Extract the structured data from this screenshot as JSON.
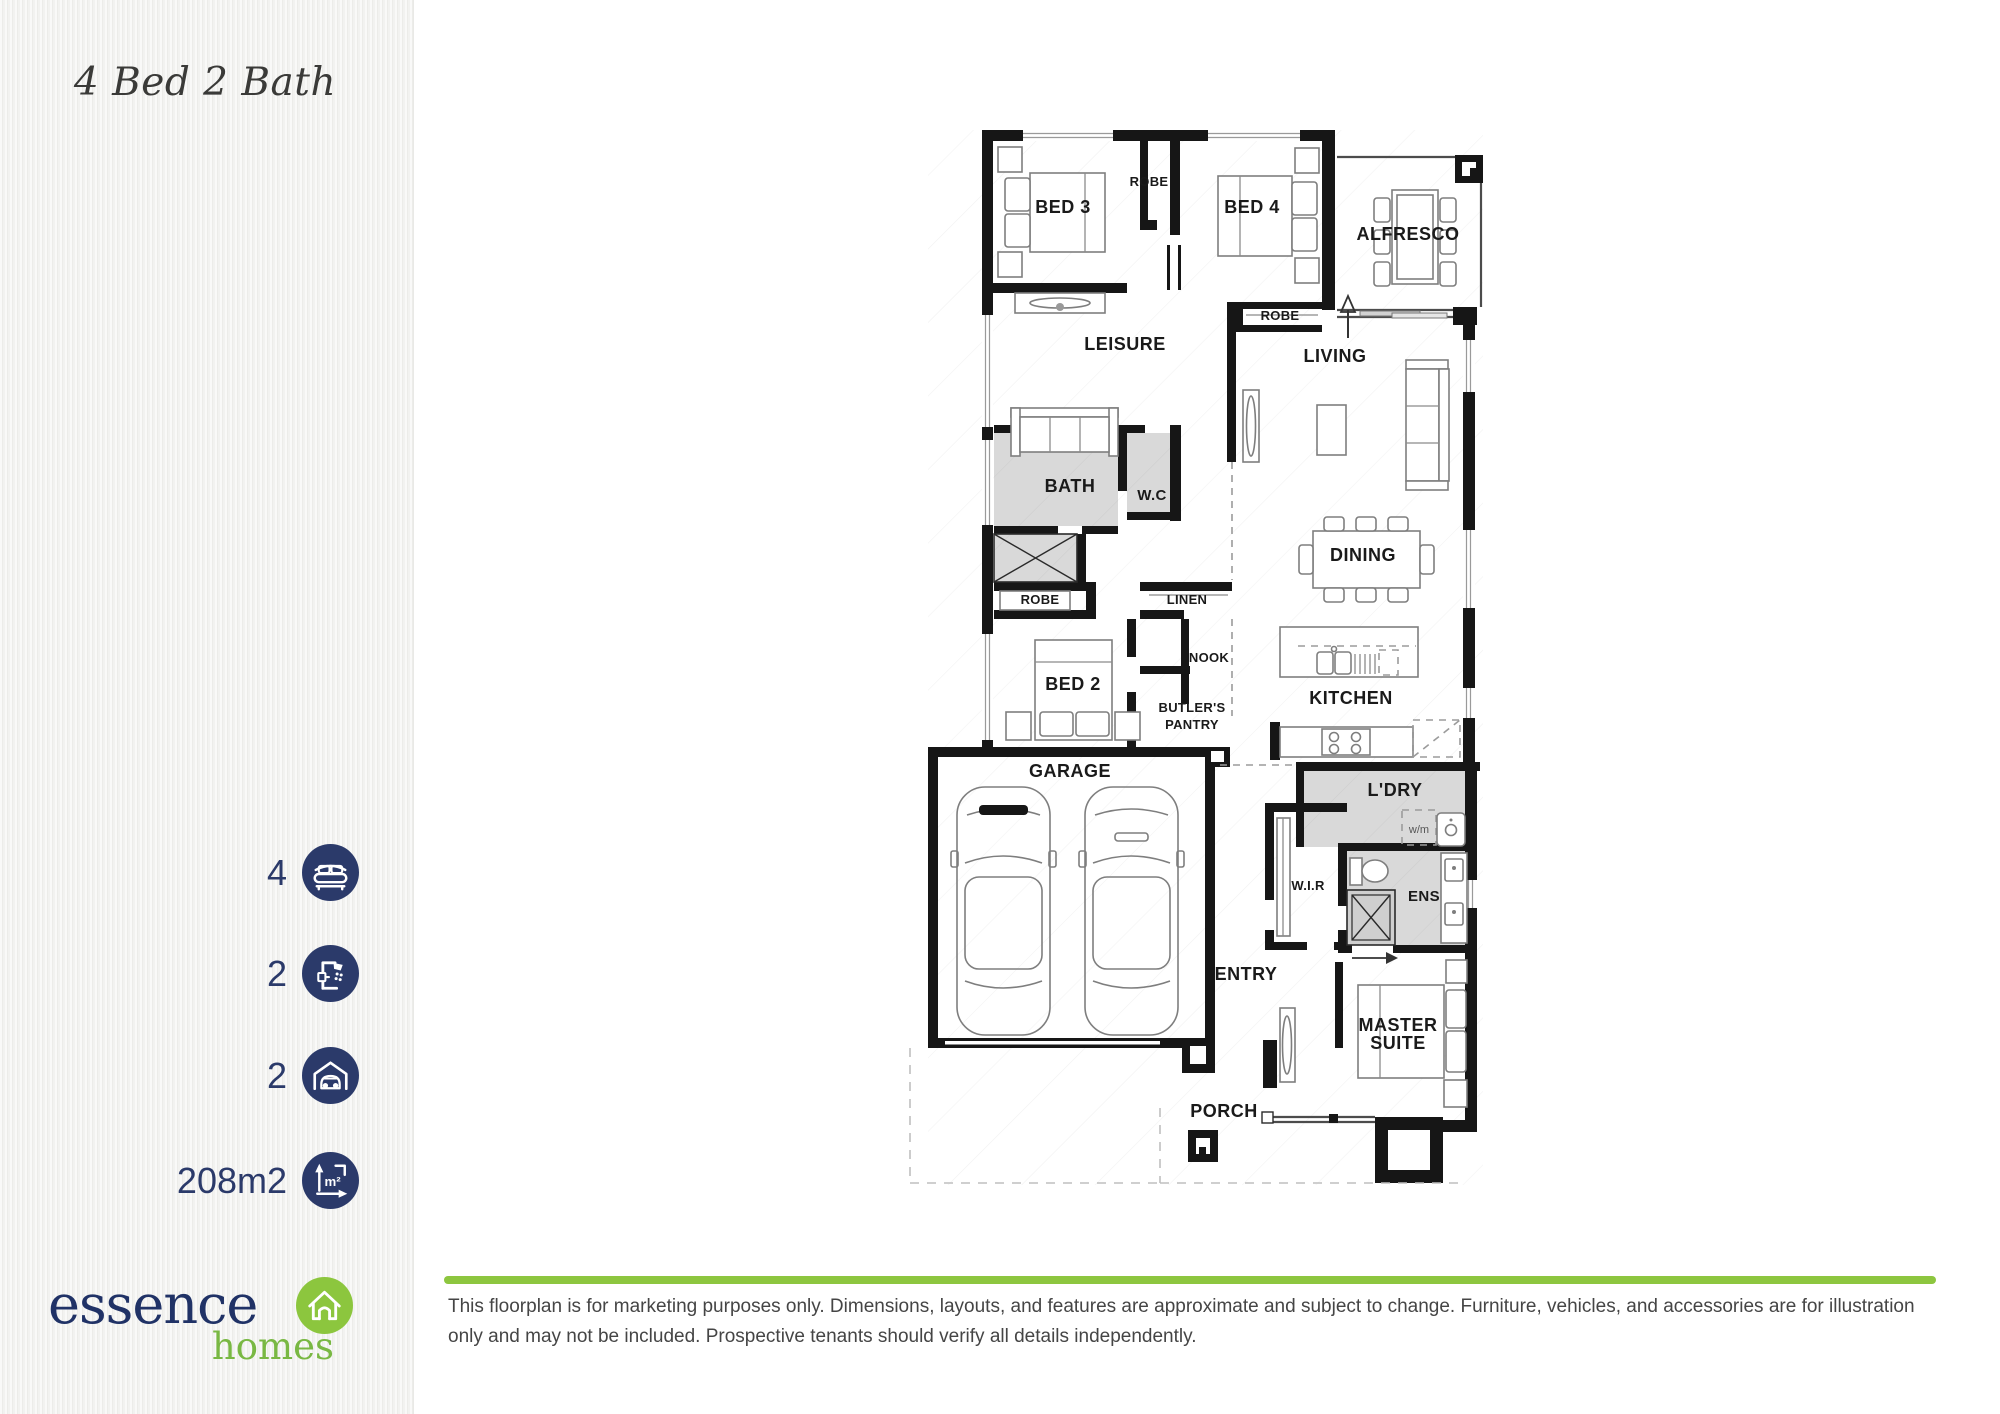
{
  "sidebar": {
    "title": "4 Bed 2 Bath",
    "stats": [
      {
        "icon": "bed-icon",
        "value": "4"
      },
      {
        "icon": "shower-icon",
        "value": "2"
      },
      {
        "icon": "garage-car-icon",
        "value": "2"
      },
      {
        "icon": "floor-area-icon",
        "value": "208m2",
        "icon_glyph": "m²"
      }
    ],
    "logo": {
      "brand": "essence",
      "suffix": "homes"
    }
  },
  "floorplan": {
    "labels": {
      "bed3": "BED 3",
      "robe_top": "ROBE",
      "bed4": "BED 4",
      "robe_bed4": "ROBE",
      "alfresco": "ALFRESCO",
      "leisure": "LEISURE",
      "living": "LIVING",
      "bath": "BATH",
      "wc": "W.C",
      "dining": "DINING",
      "robe_mid": "ROBE",
      "linen": "LINEN",
      "nook": "NOOK",
      "bed2": "BED 2",
      "butlers_1": "BUTLER'S",
      "butlers_2": "PANTRY",
      "kitchen": "KITCHEN",
      "garage": "GARAGE",
      "ldry": "L'DRY",
      "wm": "w/m",
      "wir": "W.I.R",
      "ens": "ENS",
      "entry": "ENTRY",
      "master_1": "MASTER",
      "master_2": "SUITE",
      "porch": "PORCH"
    }
  },
  "footer": {
    "disclaimer": "This floorplan is for marketing purposes only. Dimensions, layouts, and features are approximate and subject to change. Furniture, vehicles, and accessories are for illustration only and may not be included. Prospective tenants should verify all details independently."
  },
  "colors": {
    "navy": "#2b3a6a",
    "logo_navy": "#203266",
    "green": "#8dc63f",
    "logo_green": "#79b843",
    "wall": "#161616",
    "wet_area": "#d9d9d9",
    "sidebar_bg": "#f3f3f1",
    "disclaimer_text": "#454545"
  }
}
